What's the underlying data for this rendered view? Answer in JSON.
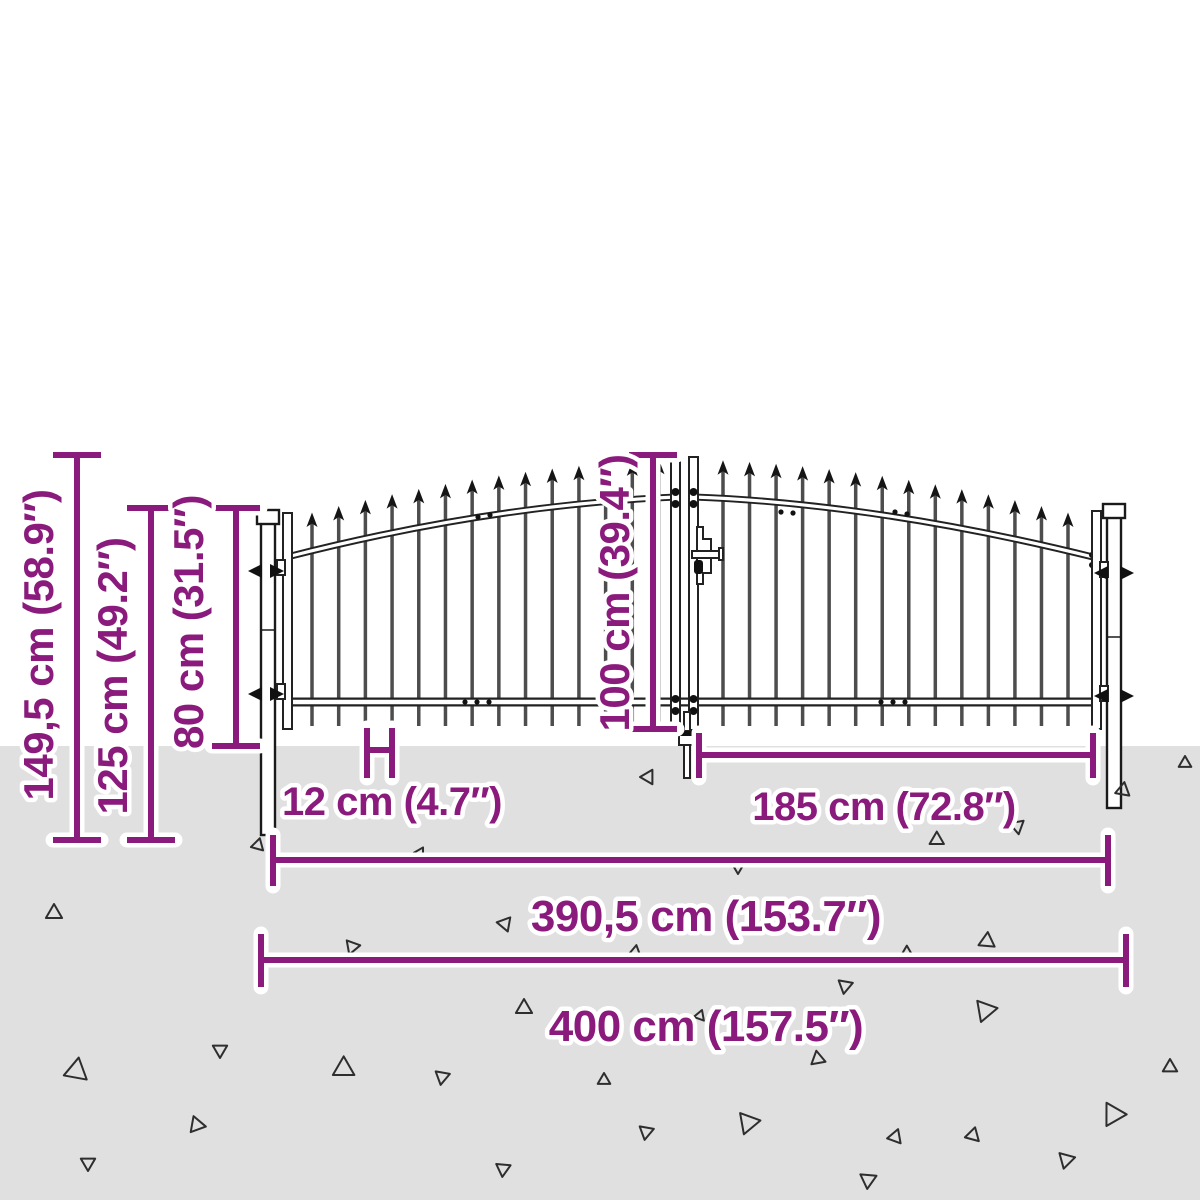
{
  "image_type": "product-dimension-diagram",
  "subject": "double-door garden gate with spear top fence",
  "colors": {
    "accent": "#8a1b7c",
    "ground": "#e1e0e0",
    "metal": "#222222"
  },
  "dimensions": {
    "v_149_5": "149,5 cm (58.9″)",
    "v_125": "125 cm (49.2″)",
    "v_80": "80 cm (31.5″)",
    "v_100": "100 cm (39.4″)",
    "h_12": "12 cm (4.7″)",
    "h_185": "185 cm (72.8″)",
    "h_390_5": "390,5 cm (153.7″)",
    "h_400": "400 cm (157.5″)"
  }
}
